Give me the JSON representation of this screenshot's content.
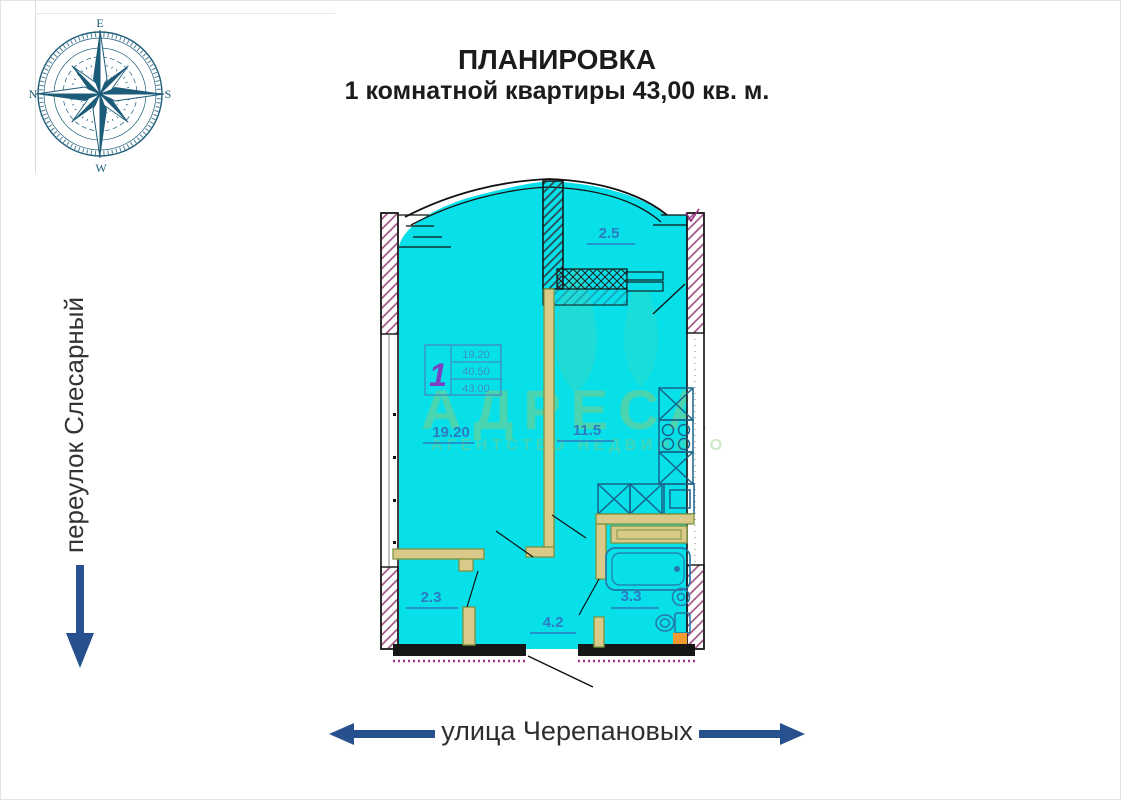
{
  "title": {
    "line1": "ПЛАНИРОВКА",
    "line2": "1 комнатной квартиры 43,00 кв. м."
  },
  "compass": {
    "n": "N",
    "e": "E",
    "s": "S",
    "w": "W"
  },
  "streets": {
    "left": "переулок Слесарный",
    "bottom": "улица Черепановых"
  },
  "watermark": {
    "brand": "АДРЕСА",
    "subtext": "АГЕНТСТВО НЕДВИЖИМОСТИ"
  },
  "info_table": {
    "unit_number": "1",
    "rows": [
      "19.20",
      "40.50",
      "43.00"
    ]
  },
  "plan": {
    "rooms": [
      {
        "name": "living-room",
        "area": "19.20"
      },
      {
        "name": "kitchen",
        "area": "11.5"
      },
      {
        "name": "balcony",
        "area": "2.5"
      },
      {
        "name": "wardrobe",
        "area": "2.3"
      },
      {
        "name": "hallway",
        "area": "4.2"
      },
      {
        "name": "bathroom",
        "area": "3.3"
      }
    ]
  },
  "colors": {
    "floor_fill": "#07dfe9",
    "wall": "#1a1a1a",
    "partition_stroke": "#7d9440",
    "partition_fill": "#d9ca8a",
    "fixture_blue": "#2777a8",
    "label_blue": "#2b7cc0",
    "arrow_blue": "#27508f",
    "compass_teal": "#1d5c78",
    "watermark_green": "#8ecb78",
    "hatch_magenta": "#9b4a7d",
    "dotted_magenta": "#b03090",
    "accent_orange": "#f29a2e",
    "unit_number_purple": "#7b3fc4"
  }
}
